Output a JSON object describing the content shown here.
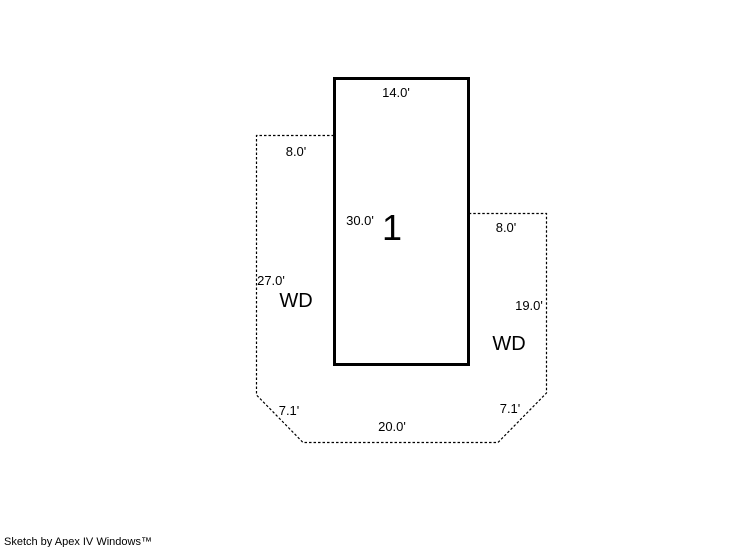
{
  "page": {
    "background_color": "#ffffff",
    "line_color": "#000000",
    "footer": "Sketch by Apex IV Windows™"
  },
  "sketch": {
    "area_label": "1",
    "deck_left_label": "WD",
    "deck_right_label": "WD",
    "dimensions": {
      "building_top": "14.0'",
      "building_left": "30.0'",
      "deck_left_top": "8.0'",
      "deck_left_side": "27.0'",
      "deck_left_diagonal": "7.1'",
      "deck_bottom": "20.0'",
      "deck_right_diagonal": "7.1'",
      "deck_right_side": "19.0'",
      "deck_right_top": "8.0'"
    }
  }
}
